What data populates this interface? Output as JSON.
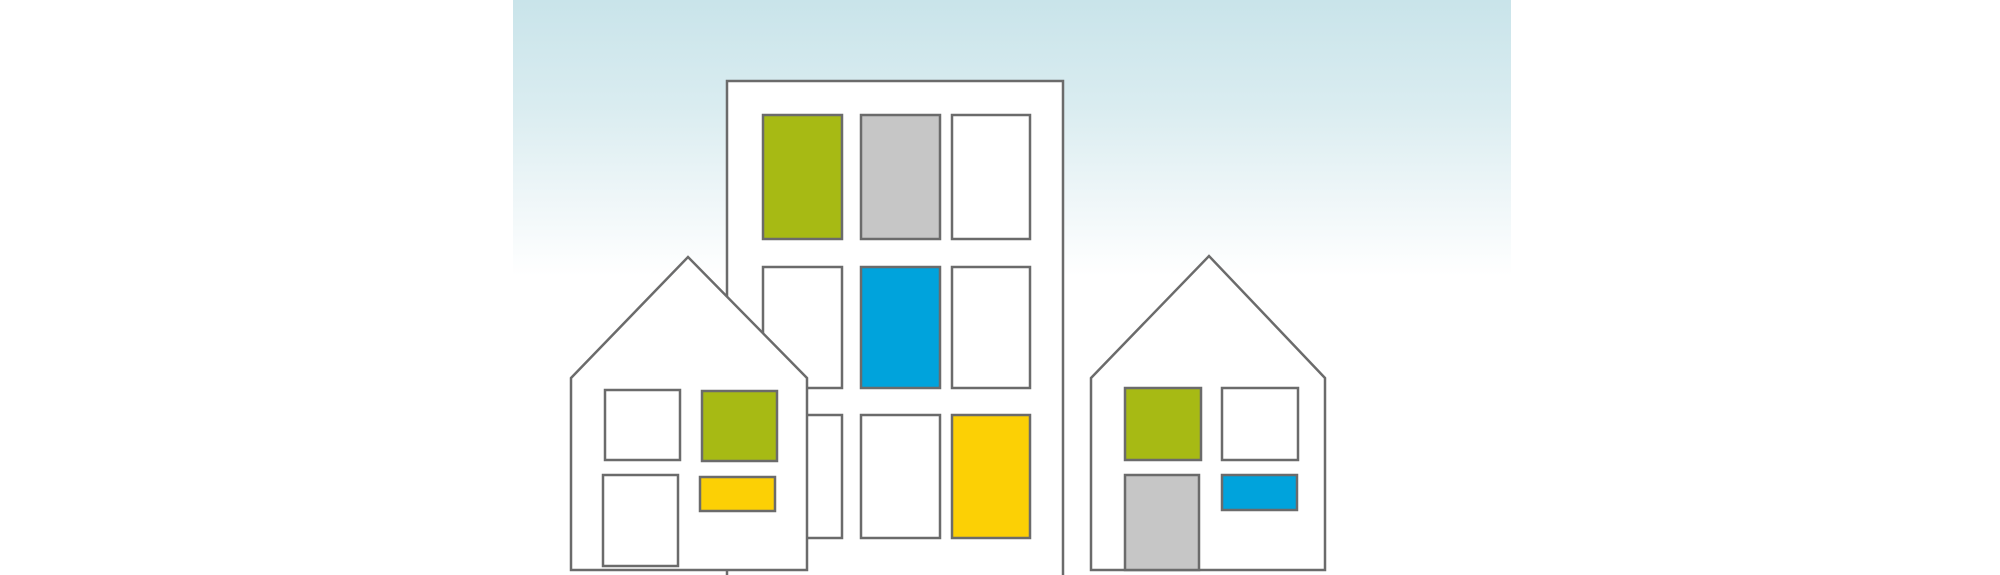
{
  "scene": {
    "title": "city-houses-illustration",
    "description": "Flat illustration of a tall apartment building and two gabled houses with colored windows on a pale teal-to-white gradient sky panel",
    "colors": {
      "white": "#ffffff",
      "green": "#a7ba14",
      "gray": "#c6c6c6",
      "blue": "#00a3dc",
      "yellow": "#fcd005",
      "outline": "#6b6b6b",
      "sky_top": "#c9e4ea",
      "sky_bottom": "#ffffff"
    },
    "buildings": {
      "apartment_tower": {
        "label": "apartment-tower",
        "window_rows": 3,
        "window_cols": 3,
        "window_colors_grid": [
          [
            "green",
            "gray",
            "white"
          ],
          [
            "white",
            "blue",
            "white"
          ],
          [
            "white",
            "white",
            "yellow"
          ]
        ]
      },
      "left_house": {
        "label": "left-house",
        "window_colors_grid": [
          [
            "white",
            "green"
          ],
          [
            "white",
            "yellow"
          ]
        ]
      },
      "right_house": {
        "label": "right-house",
        "window_colors_grid": [
          [
            "green",
            "white"
          ],
          [
            "gray",
            "blue"
          ]
        ]
      }
    }
  }
}
